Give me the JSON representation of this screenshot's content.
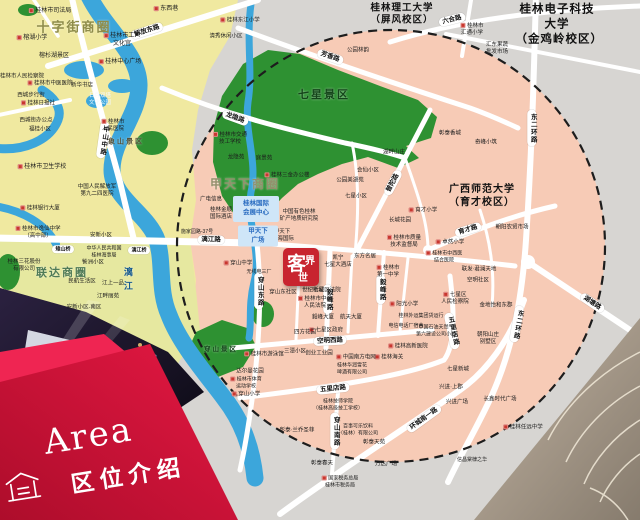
{
  "banner": {
    "title_en": "Area",
    "title_zh": "区位介绍"
  },
  "logo": {
    "char1": "客",
    "char2": "界",
    "char3": "世"
  },
  "colors": {
    "brand_red": "#c8242f",
    "banner_red": "#d8123a",
    "banner_red_light": "#ef2552",
    "map_salmon": "#f7cbb6",
    "map_yellow": "#f0e9a0",
    "map_yellow2": "#e6e8a0",
    "map_gray": "#d7d5d2",
    "park_green": "#2e9132",
    "river_blue": "#3ca6db",
    "poi_red": "#c9372e",
    "infobox_blue": "#cfe6f8",
    "infobox_text": "#2a6cc0"
  },
  "zones": [
    {
      "label": "十字街商圈",
      "x": 74,
      "y": 28,
      "fs": 13,
      "color": "#8e8c4a"
    },
    {
      "label": "甲天下商圈",
      "x": 245,
      "y": 185,
      "fs": 12,
      "color": "#93906c"
    },
    {
      "label": "联达商圈",
      "x": 62,
      "y": 273,
      "fs": 11,
      "color": "#4f7a57"
    },
    {
      "label": "七星景区",
      "x": 324,
      "y": 95,
      "fs": 11,
      "color": "#14451a"
    },
    {
      "label": "穿山景区",
      "x": 221,
      "y": 350,
      "fs": 6.5,
      "color": "#14451a"
    },
    {
      "label": "象山景区",
      "x": 126,
      "y": 142,
      "fs": 7,
      "color": "#55523a"
    }
  ],
  "universities": [
    {
      "label": "桂林理工大学\n（屏风校区）",
      "x": 402,
      "y": 15,
      "fs": 9.5
    },
    {
      "label": "桂林电子科技大学\n（金鸡岭校区）",
      "x": 557,
      "y": 25,
      "fs": 11.5
    },
    {
      "label": "广西师范大学\n（育才校区）",
      "x": 482,
      "y": 196,
      "fs": 10
    }
  ],
  "roads": [
    {
      "label": "解放东路",
      "x": 147,
      "y": 31,
      "rot": -18
    },
    {
      "label": "中山中路",
      "x": 103,
      "y": 140,
      "vertical": true,
      "rot": 8
    },
    {
      "label": "龙隐路",
      "x": 235,
      "y": 118,
      "rot": 20
    },
    {
      "label": "芳香路",
      "x": 330,
      "y": 57,
      "rot": 19
    },
    {
      "label": "六合路",
      "x": 452,
      "y": 20,
      "rot": -14
    },
    {
      "label": "漓江路",
      "x": 211,
      "y": 240,
      "rot": 1
    },
    {
      "label": "雉山桥",
      "x": 63,
      "y": 249,
      "fs": 5
    },
    {
      "label": "漓江桥",
      "x": 139,
      "y": 250,
      "fs": 5
    },
    {
      "label": "东二环路",
      "x": 532,
      "y": 128,
      "vertical": true
    },
    {
      "label": "东二环路",
      "x": 517,
      "y": 324,
      "vertical": true,
      "rot": 10
    },
    {
      "label": "湖塘路",
      "x": 592,
      "y": 303,
      "rot": 34
    },
    {
      "label": "环城南一路",
      "x": 424,
      "y": 419,
      "rot": -36
    },
    {
      "label": "普陀路",
      "x": 393,
      "y": 183,
      "rot": -62
    },
    {
      "label": "育才路",
      "x": 468,
      "y": 230,
      "rot": -17
    },
    {
      "label": "空明西路",
      "x": 330,
      "y": 341,
      "rot": -3
    },
    {
      "label": "五里店路",
      "x": 333,
      "y": 389,
      "rot": -6
    },
    {
      "label": "五里店路",
      "x": 452,
      "y": 331,
      "vertical": true,
      "rot": -12
    },
    {
      "label": "毅峰路",
      "x": 328,
      "y": 299,
      "vertical": true
    },
    {
      "label": "毅峰路",
      "x": 381,
      "y": 289,
      "vertical": true
    },
    {
      "label": "穿山东路",
      "x": 259,
      "y": 291,
      "vertical": true
    },
    {
      "label": "穿山南路",
      "x": 335,
      "y": 431,
      "vertical": true
    }
  ],
  "rivers": [
    {
      "label": "漓江",
      "x": 127,
      "y": 281
    }
  ],
  "infoboxes": [
    {
      "label": "桂林国际\n会展中心",
      "x": 256,
      "y": 209,
      "w": 46,
      "h": 26
    },
    {
      "label": "甲天下\n广场",
      "x": 258,
      "y": 236,
      "w": 40,
      "h": 21
    }
  ],
  "places": [
    {
      "label": "桂林市司法局",
      "x": 50,
      "y": 12,
      "marker": true
    },
    {
      "label": "东西巷",
      "x": 166,
      "y": 10,
      "marker": true
    },
    {
      "label": "桂林市工人\n文化宫",
      "x": 122,
      "y": 41,
      "marker": true
    },
    {
      "label": "桂林中心广场",
      "x": 120,
      "y": 63,
      "marker": true
    },
    {
      "label": "榕湖小学",
      "x": 32,
      "y": 39,
      "marker": true
    },
    {
      "label": "榕杉湖景区",
      "x": 54,
      "y": 57
    },
    {
      "label": "桂林市人民检察院",
      "x": 22,
      "y": 77,
      "fs": 5.5
    },
    {
      "label": "桂林市中医医院",
      "x": 50,
      "y": 84,
      "marker": true,
      "fs": 5.5
    },
    {
      "label": "新华书店",
      "x": 82,
      "y": 86,
      "fs": 5.5
    },
    {
      "label": "西城步行街",
      "x": 31,
      "y": 96,
      "fs": 5.5
    },
    {
      "label": "桂林日报社",
      "x": 38,
      "y": 104,
      "marker": true,
      "fs": 5.5
    },
    {
      "label": "日月双塔\n文化公园",
      "x": 100,
      "y": 100,
      "fs": 5.5,
      "color": "#f3f9ff"
    },
    {
      "label": "西城街办公点",
      "x": 36,
      "y": 121,
      "fs": 5.5
    },
    {
      "label": "福桂小区",
      "x": 40,
      "y": 130,
      "fs": 5.5
    },
    {
      "label": "桂林市\n人民医院",
      "x": 113,
      "y": 126,
      "marker": true,
      "fs": 5.5
    },
    {
      "label": "桂林市卫生学校",
      "x": 42,
      "y": 168,
      "marker": true
    },
    {
      "label": "桂林银行大厦",
      "x": 40,
      "y": 209,
      "marker": true,
      "fs": 5.5
    },
    {
      "label": "中国人民解放军\n第九二四医院",
      "x": 97,
      "y": 191,
      "fs": 5.5
    },
    {
      "label": "桂林市逸仙中学\n（高中部）",
      "x": 38,
      "y": 233,
      "fs": 5.5,
      "marker": true
    },
    {
      "label": "安新小区",
      "x": 101,
      "y": 236,
      "fs": 5.5
    },
    {
      "label": "中华人民共和国\n桂林海事局",
      "x": 104,
      "y": 252,
      "fs": 5
    },
    {
      "label": "訾洲小区",
      "x": 93,
      "y": 263,
      "fs": 5.5
    },
    {
      "label": "民航生活区",
      "x": 82,
      "y": 282,
      "fs": 5.5
    },
    {
      "label": "江上一品",
      "x": 113,
      "y": 284,
      "fs": 5.5
    },
    {
      "label": "江畔丽苑",
      "x": 108,
      "y": 297,
      "fs": 5.5
    },
    {
      "label": "安新小区-南区",
      "x": 84,
      "y": 308,
      "fs": 5.5
    },
    {
      "label": "桂林三花股份\n有限公司",
      "x": 24,
      "y": 266,
      "fs": 5.5
    },
    {
      "label": "桂林东江小学",
      "x": 240,
      "y": 21,
      "fs": 5.5,
      "marker": true
    },
    {
      "label": "清秀休闲小区",
      "x": 226,
      "y": 37,
      "fs": 5.5
    },
    {
      "label": "桂林市\n汇通小学",
      "x": 472,
      "y": 30,
      "marker": true,
      "fs": 5.5
    },
    {
      "label": "汇东果蔬\n批发市场",
      "x": 497,
      "y": 49,
      "fs": 5.5
    },
    {
      "label": "公园林韵",
      "x": 358,
      "y": 51,
      "fs": 5.5
    },
    {
      "label": "彰泰香城",
      "x": 450,
      "y": 134,
      "fs": 5.5
    },
    {
      "label": "奇峰小筑",
      "x": 486,
      "y": 143,
      "fs": 5.5
    },
    {
      "label": "桂林市交通\n技工学校",
      "x": 230,
      "y": 139,
      "marker": true,
      "fs": 5.5
    },
    {
      "label": "龙隐苑",
      "x": 236,
      "y": 158,
      "fs": 5.5
    },
    {
      "label": "庭景苑",
      "x": 264,
      "y": 159,
      "fs": 5.5
    },
    {
      "label": "桂林三金办公楼",
      "x": 287,
      "y": 176,
      "fs": 5.5,
      "marker": true
    },
    {
      "label": "广电信息",
      "x": 211,
      "y": 200,
      "fs": 5.5
    },
    {
      "label": "桂林金顺\n国际酒店",
      "x": 221,
      "y": 214,
      "fs": 5.5
    },
    {
      "label": "中国有色桂林\n矿产地质研究院",
      "x": 299,
      "y": 216,
      "fs": 5.5
    },
    {
      "label": "施家园路-37号",
      "x": 197,
      "y": 232,
      "fs": 5
    },
    {
      "label": "甲天下\n·鑫海国际",
      "x": 282,
      "y": 236,
      "fs": 5.5
    },
    {
      "label": "凯宁\n七星大酒店",
      "x": 338,
      "y": 262,
      "fs": 5.5
    },
    {
      "label": "东方名居",
      "x": 365,
      "y": 257,
      "fs": 5.5
    },
    {
      "label": "天惠佳园",
      "x": 305,
      "y": 281,
      "fs": 5.5
    },
    {
      "label": "世纪新城",
      "x": 313,
      "y": 291,
      "fs": 5.5
    },
    {
      "label": "穿山东社区",
      "x": 283,
      "y": 293,
      "fs": 5.5
    },
    {
      "label": "七星区法院",
      "x": 327,
      "y": 291,
      "fs": 5.5
    },
    {
      "label": "桂林市中级\n人民法院",
      "x": 315,
      "y": 303,
      "fs": 5.5,
      "marker": true
    },
    {
      "label": "桂林市\n第一中学",
      "x": 388,
      "y": 272,
      "fs": 5.5,
      "marker": true
    },
    {
      "label": "桂林市质量\n技术监督局",
      "x": 404,
      "y": 242,
      "fs": 5.5,
      "marker": true
    },
    {
      "label": "阳光小学",
      "x": 404,
      "y": 305,
      "marker": true,
      "fs": 5.5
    },
    {
      "label": "桂林外运集团货运行",
      "x": 421,
      "y": 316,
      "fs": 5
    },
    {
      "label": "电信电话厂宿舍",
      "x": 406,
      "y": 326,
      "fs": 5
    },
    {
      "label": "航天大厦",
      "x": 351,
      "y": 318,
      "fs": 5.5
    },
    {
      "label": "毅峰大厦",
      "x": 323,
      "y": 318,
      "fs": 5.5
    },
    {
      "label": "七星区政府",
      "x": 326,
      "y": 331,
      "fs": 5.5,
      "marker": true
    },
    {
      "label": "四方花园",
      "x": 305,
      "y": 333,
      "fs": 5.5
    },
    {
      "label": "中国石油天然气\n第六建设公司小区",
      "x": 436,
      "y": 331,
      "fs": 5
    },
    {
      "label": "桂林高新医院",
      "x": 408,
      "y": 347,
      "marker": true,
      "fs": 5.5
    },
    {
      "label": "桂林海关",
      "x": 389,
      "y": 358,
      "marker": true,
      "fs": 5.5
    },
    {
      "label": "中国南方电网",
      "x": 356,
      "y": 358,
      "fs": 5.5,
      "marker": true
    },
    {
      "label": "创业工业园",
      "x": 319,
      "y": 354,
      "fs": 5.5
    },
    {
      "label": "三潭小区",
      "x": 295,
      "y": 352,
      "fs": 5.5
    },
    {
      "label": "桂林华润雪花\n啤酒有限公司",
      "x": 352,
      "y": 369,
      "fs": 5
    },
    {
      "label": "桂林市游泳馆",
      "x": 264,
      "y": 355,
      "fs": 5.5,
      "marker": true
    },
    {
      "label": "达尔曼花园",
      "x": 250,
      "y": 372,
      "fs": 5.5
    },
    {
      "label": "桂林市体育\n运动学校",
      "x": 246,
      "y": 383,
      "fs": 5,
      "marker": true
    },
    {
      "label": "穿山小学",
      "x": 246,
      "y": 395,
      "fs": 5.5,
      "marker": true
    },
    {
      "label": "彰泰·兰乔圣菲",
      "x": 297,
      "y": 431,
      "fs": 5.5
    },
    {
      "label": "彰泰春天",
      "x": 322,
      "y": 464,
      "fs": 5.5
    },
    {
      "label": "彰泰天苑",
      "x": 374,
      "y": 443,
      "fs": 5.5
    },
    {
      "label": "万达广场",
      "x": 386,
      "y": 465,
      "fs": 5.5
    },
    {
      "label": "百事可乐饮料\n（桂林）有限公司",
      "x": 358,
      "y": 430,
      "fs": 5
    },
    {
      "label": "国家税务总局\n桂林市税务局",
      "x": 340,
      "y": 482,
      "fs": 5,
      "marker": true
    },
    {
      "label": "桂林技师学院\n（桂林高级技工学校）",
      "x": 338,
      "y": 405,
      "fs": 5
    },
    {
      "label": "育才小学",
      "x": 423,
      "y": 211,
      "marker": true,
      "fs": 5.5
    },
    {
      "label": "长城花园",
      "x": 400,
      "y": 221,
      "fs": 5.5
    },
    {
      "label": "朝阳农贸市场",
      "x": 512,
      "y": 228,
      "fs": 5.5
    },
    {
      "label": "卓然小学",
      "x": 450,
      "y": 243,
      "marker": true,
      "fs": 5.5
    },
    {
      "label": "桂林市中西医\n结合医院",
      "x": 444,
      "y": 257,
      "fs": 5,
      "marker": true
    },
    {
      "label": "空明社区",
      "x": 478,
      "y": 281,
      "fs": 5.5
    },
    {
      "label": "七星区\n人民检察院",
      "x": 455,
      "y": 299,
      "fs": 5.5,
      "marker": true
    },
    {
      "label": "联发·君澜天地",
      "x": 479,
      "y": 270,
      "fs": 5.5
    },
    {
      "label": "金地怡和东郡",
      "x": 496,
      "y": 306,
      "fs": 5.5
    },
    {
      "label": "朝阳山庄\n别墅区",
      "x": 488,
      "y": 339,
      "fs": 5.5
    },
    {
      "label": "七星新城",
      "x": 458,
      "y": 370,
      "fs": 5.5
    },
    {
      "label": "兴进·上郡",
      "x": 451,
      "y": 388,
      "fs": 5.5
    },
    {
      "label": "兴进广场",
      "x": 457,
      "y": 403,
      "fs": 5.5
    },
    {
      "label": "长鑫时代广场",
      "x": 500,
      "y": 400,
      "fs": 5.5
    },
    {
      "label": "桂林任远中学",
      "x": 523,
      "y": 428,
      "fs": 5.5,
      "marker": true
    },
    {
      "label": "信昌棠棣之华",
      "x": 472,
      "y": 460,
      "fs": 5
    },
    {
      "label": "七星小区",
      "x": 356,
      "y": 197,
      "fs": 5.5
    },
    {
      "label": "会仙小区",
      "x": 368,
      "y": 171,
      "fs": 5.5
    },
    {
      "label": "湖畔山庄",
      "x": 394,
      "y": 153,
      "fs": 5.5
    },
    {
      "label": "公园美湖苑",
      "x": 350,
      "y": 181,
      "fs": 5.5
    },
    {
      "label": "穿山中学",
      "x": 238,
      "y": 264,
      "fs": 5.5,
      "marker": true
    },
    {
      "label": "无线电三厂",
      "x": 259,
      "y": 272,
      "fs": 5
    }
  ]
}
